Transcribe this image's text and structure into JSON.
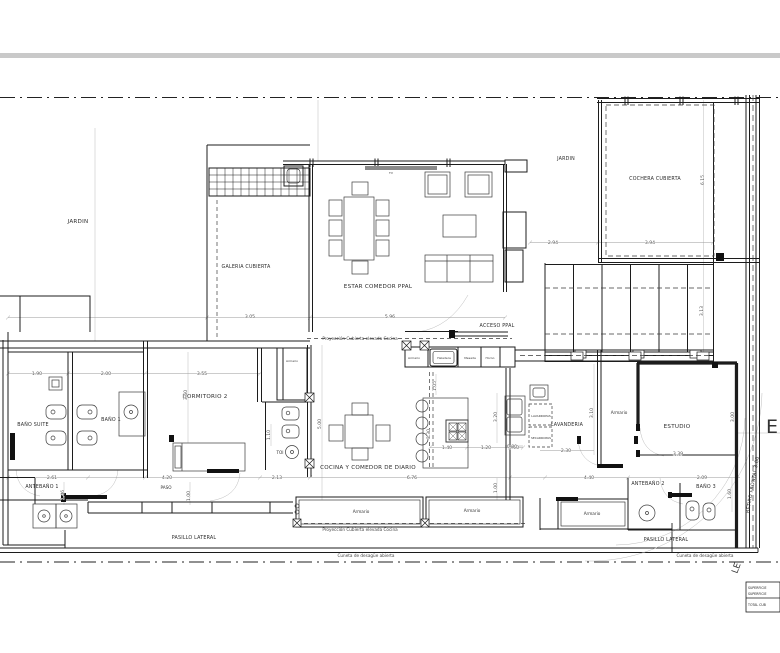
{
  "plan": {
    "rooms": {
      "jardin": "JARDIN",
      "galeria_cubierta": "GALERIA CUBIERTA",
      "estar_comedor": "ESTAR COMEDOR PPAL",
      "cochera_cubierta": "COCHERA CUBIERTA",
      "acceso_ppal": "ACCESO PPAL",
      "dormitorio_2": "DORMITORIO 2",
      "bano_suite": "BAÑO SUITE",
      "bano_1": "BAÑO 1",
      "antebano_1": "ANTEBAÑO 1",
      "toi": "TOI",
      "paso": "PASO",
      "cocina_comedor_diario": "COCINA Y COMEDOR DE DIARIO",
      "lavanderia": "LAVANDERIA",
      "estudio": "ESTUDIO",
      "antebano_2": "ANTEBAÑO 2",
      "bano_3": "BAÑO 3",
      "pasillo_lateral": "PASILLO LATERAL"
    },
    "fixtures": {
      "armario": "Armario",
      "heladera": "Heladera",
      "mesada": "Mesada",
      "horno": "Horno",
      "lavarropas": "LAVARROPAS",
      "secarropas": "SECARROPAS",
      "tv": "TV"
    },
    "annotations": {
      "proyeccion_cocina": "Proyección Cubierta elevada Cocina",
      "cuneta": "Cuneta de desagüe abierta",
      "retiro_frontal": "RETIRO FRONTAL 3.00",
      "le": "LE",
      "street_letter": "E"
    },
    "dimensions": {
      "bano_suite_w": "1.90",
      "bano_1_w": "2.00",
      "antebano_1_w": "2.61",
      "antebano_1_h": "1.46",
      "dormitorio_2_w": "3.55",
      "dormitorio_2_h": "3.60",
      "paso_w": "4.20",
      "paso_h": "1.00",
      "toi_w": "2.13",
      "toi_h": "1.10",
      "cocina_h": "5.00",
      "cocina_w": "6.76",
      "isla_w": "1.40",
      "isla_gap": "1.20",
      "mueble_w": "0.60",
      "cocina_right_h": "3.20",
      "cocina_centro_h": "3.30",
      "cocina_top_h": "1.05",
      "cocina_bottom_h": "1.00",
      "lavanderia_mesada": "0.80",
      "lavanderia_w": "2.30",
      "lavanderia_h": "3.10",
      "pasillo_w": "4.40",
      "estudio_w": "3.39",
      "estudio_h": "3.00",
      "bano_3_w": "2.09",
      "bano_3_h": "1.60",
      "cochera_left_w": "2.94",
      "cochera_w": "3.94",
      "cochera_h": "6.15",
      "deck_h": "3.13",
      "estar_w": "5.96",
      "galeria_w": "3.05"
    },
    "legend": {
      "row_1": "SUPERFICIE",
      "row_2": "SUPERFICIE",
      "row_3": "TOTAL CUB"
    }
  }
}
